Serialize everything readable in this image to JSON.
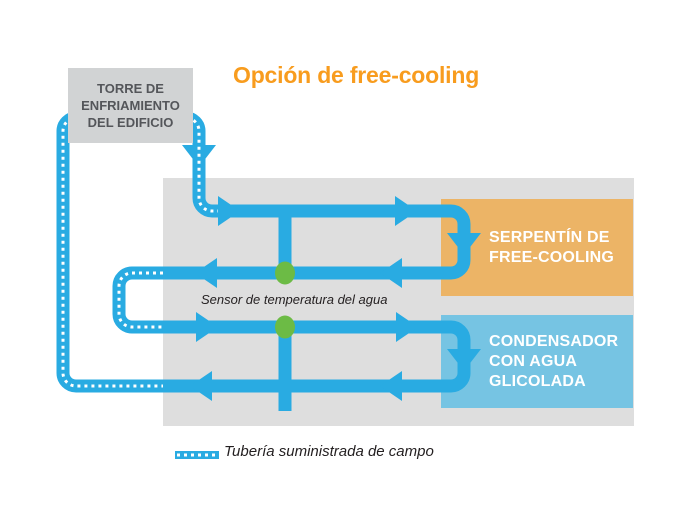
{
  "title": {
    "text": "Opción de free-cooling",
    "color": "#F89C1E"
  },
  "tower": {
    "label": "TORRE DE\nENFRIAMIENTO\nDEL EDIFICIO",
    "bg": "#D1D3D4",
    "text_color": "#54565A"
  },
  "panel": {
    "bg": "#DEDEDE"
  },
  "boxes": {
    "free_cooling_coil": {
      "label": "SERPENTÍN DE\nFREE-COOLING",
      "bg": "#ECB466",
      "text_color": "#FFFFFF"
    },
    "glycol_condenser": {
      "label": "CONDENSADOR\nCON AGUA\nGLICOLADA",
      "bg": "#76C4E3",
      "text_color": "#FFFFFF"
    }
  },
  "sensor": {
    "label": "Sensor de temperatura del agua",
    "dot_color": "#6CBB45",
    "text_color": "#231F20"
  },
  "legend": {
    "label": "Tubería suministrada de campo",
    "text_color": "#231F20"
  },
  "pipe": {
    "color": "#29ABE2",
    "dash_color": "#FFFFFF"
  }
}
